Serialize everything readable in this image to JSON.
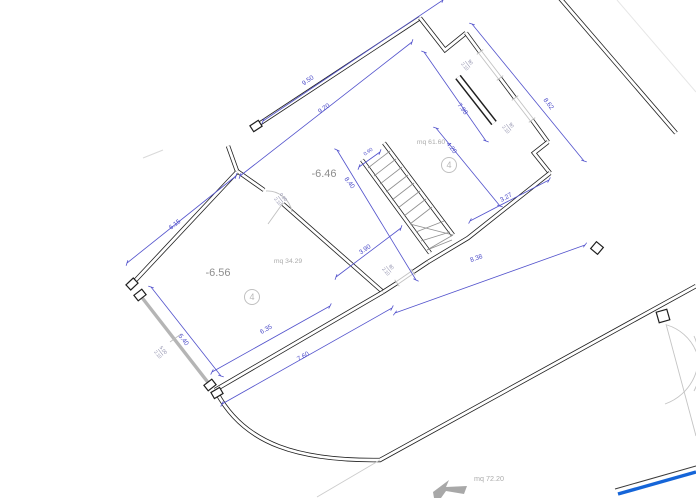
{
  "dims": {
    "top_outer": "9.50",
    "top_inner": "9.20",
    "east_outer": "8.62",
    "east_inner": "7.98",
    "annex_width": "4.20",
    "stair_opening": "0.90",
    "stair_flight": "8.40",
    "annex_south": "3.27",
    "room_a_west": "6.15",
    "stair_room": "3.90",
    "south_total": "8.38",
    "room_b_width": "6.35",
    "south_outer": "7.60",
    "room_b_west": "5.40"
  },
  "windows": {
    "ne1": {
      "w": "90",
      "h": "2.10"
    },
    "ne2": {
      "w": "90",
      "h": "2.10"
    },
    "south": {
      "w": "80",
      "h": "2.10"
    },
    "west": {
      "w": "5.00",
      "h": "2.10"
    }
  },
  "doors": {
    "stair": {
      "w": "0.80",
      "h": "2.10"
    }
  },
  "rooms": {
    "a": {
      "level": "-6.46",
      "area": "mq 61.60",
      "badge": "4"
    },
    "b": {
      "level": "-6.56",
      "area": "mq 34.29",
      "badge": "4"
    },
    "outdoor": {
      "area": "mq 72.20"
    }
  },
  "colors": {
    "dimension": "#5252cc",
    "wall": "#1f1f1f",
    "annotation_gray": "#9e9e9e",
    "boundary_blue": "#1565d8",
    "glazing_gray": "#b5b5b5"
  }
}
